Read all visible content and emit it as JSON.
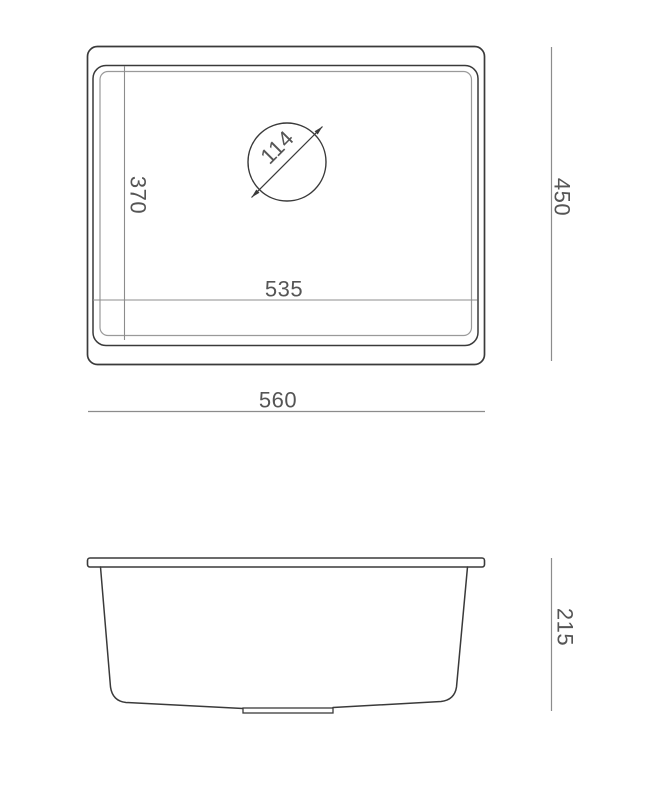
{
  "colors": {
    "background": "#ffffff",
    "outline": "#3a3a3a",
    "outline_light": "#9a9a9a",
    "dimension_line": "#8c8c8c",
    "dimension_text": "#555555"
  },
  "top_view": {
    "overall_width": "560",
    "overall_depth": "450",
    "bowl_length": "535",
    "bowl_width": "370",
    "drain_diameter": "114"
  },
  "side_view": {
    "depth": "215"
  }
}
